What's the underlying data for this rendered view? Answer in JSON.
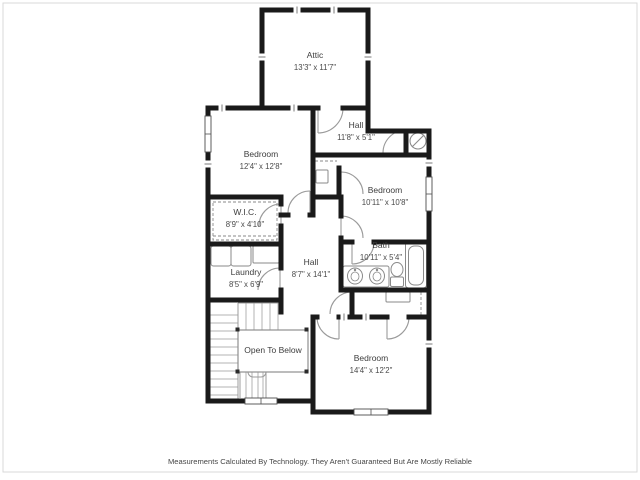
{
  "footer": {
    "disclaimer": "Measurements Calculated By Technology. They Aren't Guaranteed But Are Mostly Reliable"
  },
  "floor_plan": {
    "colors": {
      "wall": "#1a1a1a",
      "door": "#9a9a9a",
      "stair": "#b3b3b3",
      "fixture": "#8a8a8a",
      "text": "#3d3d3d",
      "frame": "#d9d9d9",
      "background": "#ffffff"
    },
    "rooms": [
      {
        "id": "attic",
        "name": "Attic",
        "dims": "13'3\" x 11'7\"",
        "x": 315,
        "y": 58
      },
      {
        "id": "bedroom-1",
        "name": "Bedroom",
        "dims": "12'4\" x 12'8\"",
        "x": 261,
        "y": 157
      },
      {
        "id": "hall-upper",
        "name": "Hall",
        "dims": "11'8\" x 5'1\"",
        "x": 356,
        "y": 128
      },
      {
        "id": "bedroom-2",
        "name": "Bedroom",
        "dims": "10'11\" x 10'8\"",
        "x": 385,
        "y": 193
      },
      {
        "id": "wic",
        "name": "W.I.C.",
        "dims": "8'9\" x 4'10\"",
        "x": 245,
        "y": 215
      },
      {
        "id": "laundry",
        "name": "Laundry",
        "dims": "8'5\" x 6'9\"",
        "x": 246,
        "y": 275
      },
      {
        "id": "hall-middle",
        "name": "Hall",
        "dims": "8'7\" x 14'1\"",
        "x": 311,
        "y": 265
      },
      {
        "id": "bath",
        "name": "Bath",
        "dims": "10'11\" x 5'4\"",
        "x": 381,
        "y": 248
      },
      {
        "id": "bedroom-3",
        "name": "Bedroom",
        "dims": "14'4\" x 12'2\"",
        "x": 371,
        "y": 361
      },
      {
        "id": "open-to-below",
        "name": "Open To Below",
        "dims": null,
        "x": 273,
        "y": 353
      }
    ],
    "walls": [
      [
        262,
        10,
        368,
        10
      ],
      [
        262,
        10,
        262,
        108
      ],
      [
        368,
        10,
        368,
        131
      ],
      [
        208,
        108,
        318,
        108
      ],
      [
        343,
        108,
        368,
        108
      ],
      [
        368,
        131,
        429,
        131
      ],
      [
        208,
        108,
        208,
        401
      ],
      [
        429,
        131,
        429,
        412
      ],
      [
        208,
        401,
        313,
        401
      ],
      [
        313,
        317,
        313,
        412
      ],
      [
        313,
        412,
        429,
        412
      ],
      [
        313,
        108,
        313,
        215
      ],
      [
        313,
        155,
        429,
        155
      ],
      [
        339,
        168,
        339,
        197
      ],
      [
        313,
        197,
        341,
        197
      ],
      [
        208,
        197,
        281,
        197
      ],
      [
        281,
        215,
        288,
        215
      ],
      [
        310,
        215,
        313,
        215
      ],
      [
        281,
        197,
        281,
        204
      ],
      [
        281,
        226,
        281,
        268
      ],
      [
        281,
        290,
        281,
        312
      ],
      [
        208,
        244,
        281,
        244
      ],
      [
        208,
        300,
        281,
        300
      ],
      [
        341,
        197,
        341,
        216
      ],
      [
        341,
        238,
        341,
        242
      ],
      [
        341,
        242,
        352,
        242
      ],
      [
        374,
        242,
        429,
        242
      ],
      [
        341,
        242,
        341,
        290
      ],
      [
        341,
        290,
        429,
        290
      ],
      [
        352,
        290,
        352,
        317
      ],
      [
        406,
        131,
        406,
        155
      ],
      [
        313,
        317,
        317,
        317
      ],
      [
        339,
        317,
        387,
        317
      ],
      [
        409,
        317,
        429,
        317
      ]
    ],
    "doors": [
      {
        "name": "attic-door",
        "leaf": [
          318,
          108,
          318,
          133
        ],
        "arc": [
          343,
          108,
          25,
          318,
          133,
          1
        ]
      },
      {
        "name": "hall-closet-door",
        "leaf": null,
        "arc": [
          406,
          130,
          23,
          383,
          153,
          0
        ]
      },
      {
        "name": "bedroom-1-door",
        "leaf": [
          310,
          213,
          310,
          191
        ],
        "arc": [
          288,
          213,
          22,
          310,
          191,
          1
        ]
      },
      {
        "name": "wic-door",
        "leaf": [
          281,
          204,
          281,
          226
        ],
        "arc": [
          281,
          204,
          22,
          259,
          226,
          0
        ]
      },
      {
        "name": "laundry-door",
        "leaf": [
          280,
          268,
          280,
          290
        ],
        "arc": [
          280,
          268,
          22,
          258,
          290,
          0
        ]
      },
      {
        "name": "bedroom-2-door",
        "leaf": [
          341,
          172,
          341,
          194
        ],
        "arc": [
          341,
          172,
          22,
          363,
          194,
          1
        ]
      },
      {
        "name": "bedroom-2-closet-door",
        "leaf": [
          341,
          216,
          341,
          238
        ],
        "arc": [
          341,
          216,
          22,
          363,
          238,
          1
        ]
      },
      {
        "name": "bath-door",
        "leaf": [
          352,
          242,
          352,
          264
        ],
        "arc": [
          374,
          242,
          22,
          352,
          264,
          1
        ]
      },
      {
        "name": "linen-closet-door",
        "leaf": [
          352,
          292,
          352,
          314
        ],
        "arc": [
          352,
          292,
          22,
          330,
          314,
          0
        ]
      },
      {
        "name": "bedroom-3-door-left",
        "leaf": [
          339,
          317,
          339,
          339
        ],
        "arc": [
          317,
          317,
          22,
          339,
          339,
          0
        ]
      },
      {
        "name": "bedroom-3-door-right",
        "leaf": [
          387,
          317,
          387,
          339
        ],
        "arc": [
          409,
          317,
          22,
          387,
          339,
          1
        ]
      }
    ],
    "windows": [
      {
        "x": 205,
        "y": 116,
        "w": 6,
        "h": 36,
        "o": "v"
      },
      {
        "x": 426,
        "y": 177,
        "w": 6,
        "h": 34,
        "o": "v"
      },
      {
        "x": 354,
        "y": 409,
        "w": 34,
        "h": 6,
        "o": "h"
      },
      {
        "x": 245,
        "y": 398,
        "w": 32,
        "h": 6,
        "o": "h"
      }
    ],
    "ticks": [
      {
        "x": 294,
        "y": 108,
        "o": "h"
      },
      {
        "x": 222,
        "y": 108,
        "o": "h"
      },
      {
        "x": 297,
        "y": 10,
        "o": "h"
      },
      {
        "x": 334,
        "y": 10,
        "o": "h"
      },
      {
        "x": 262,
        "y": 57,
        "o": "v"
      },
      {
        "x": 368,
        "y": 57,
        "o": "v"
      },
      {
        "x": 429,
        "y": 163,
        "o": "v"
      },
      {
        "x": 429,
        "y": 344,
        "o": "v"
      },
      {
        "x": 208,
        "y": 164,
        "o": "v"
      },
      {
        "x": 344,
        "y": 317,
        "o": "h"
      },
      {
        "x": 366,
        "y": 317,
        "o": "h"
      }
    ],
    "fixtures": {
      "water_heater": {
        "cx": 418,
        "cy": 141,
        "r": 8
      },
      "bath_counter": [
        343,
        266,
        46,
        21
      ],
      "sinks": [
        [
          355,
          276
        ],
        [
          377,
          276
        ]
      ],
      "toilet": {
        "tank": [
          390.5,
          277,
          13,
          9.5
        ],
        "bowl": [
          397,
          269.5,
          6,
          7
        ]
      },
      "bathtub": {
        "outer": [
          405.5,
          242,
          21,
          46
        ],
        "inner": [
          408.5,
          246,
          15,
          39
        ]
      },
      "washer": [
        211,
        246,
        20,
        20
      ],
      "dryer": [
        231,
        246,
        20,
        20
      ],
      "laundry_cabinet": [
        253,
        246,
        26,
        17
      ],
      "utility_box": [
        316,
        170,
        12,
        13
      ],
      "linen_shelf": [
        386,
        292,
        24,
        10
      ],
      "wic_shelf": [
        213,
        202,
        64,
        38
      ],
      "dashed_lines": [
        [
          315,
          161,
          337,
          161
        ],
        [
          421,
          292,
          421,
          315
        ],
        [
          213,
          236,
          277,
          236
        ]
      ]
    },
    "stairs": {
      "rails": [
        [
          238,
          303,
          238,
          399
        ],
        [
          238,
          303,
          281,
          303
        ],
        [
          240,
          366,
          240,
          398
        ],
        [
          266,
          366,
          266,
          398
        ]
      ],
      "left_treads_y": [
        315,
        323,
        331,
        339,
        347,
        355,
        363,
        371,
        379,
        387,
        395
      ],
      "left_treads_x": [
        208,
        238
      ],
      "top_treads_x": [
        246,
        254,
        262,
        270,
        278
      ],
      "top_treads_y": [
        303,
        330
      ],
      "bottom_treads_x": [
        246,
        252,
        258,
        263
      ],
      "bottom_treads_y": [
        372,
        398
      ],
      "newel": [
        248,
        365,
        18,
        12
      ],
      "open_rect": [
        238,
        330,
        70,
        42
      ],
      "posts": [
        [
          235.5,
          327.5
        ],
        [
          235.5,
          369.5
        ],
        [
          304.5,
          327.5
        ],
        [
          304.5,
          369.5
        ]
      ]
    },
    "frame": [
      3,
      3,
      634,
      469
    ]
  }
}
